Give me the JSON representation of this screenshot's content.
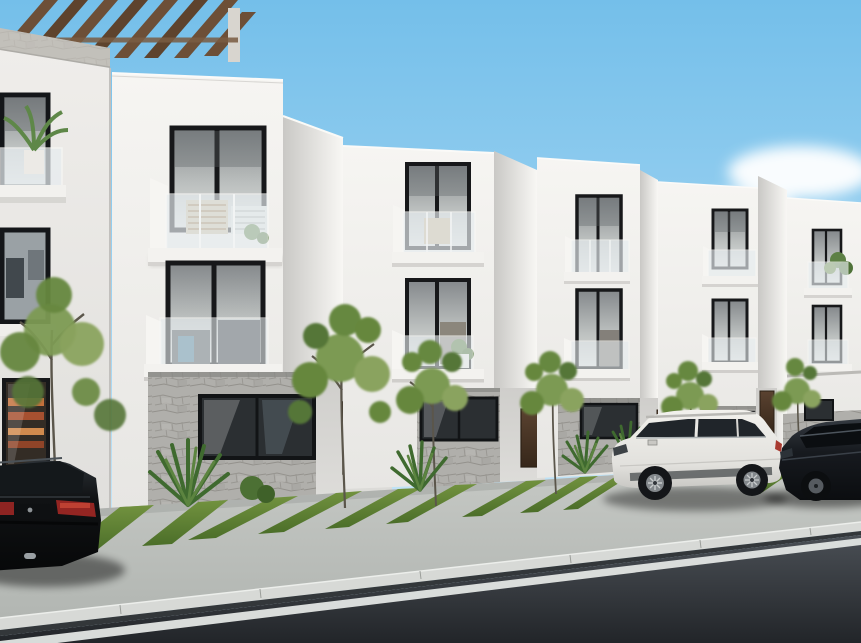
{
  "scene": {
    "type": "architectural-exterior-render",
    "description": "Photorealistic 3D exterior rendering of a row of modern white three-storey townhouses seen in perspective receding to the right. Black-framed windows, white Juliet balconies with glass railings, gray stone-clad ground floors, dark wood entry doors, landscaped front yards with small trees, agave plants and alternating grass and concrete driveway strips. A black sedan is parked at the lower left (rear view), a white wagon and a dark sedan are parked in driveways to the right. Light gray sidewalk and curb with a dark asphalt street and white edge line in the foreground, under a clear blue sky with soft clouds on the right. A wood slat pergola tops the closest building at the upper left.",
    "sky": {
      "top_color": "#76c0ea",
      "horizon_color": "#d7ecf8",
      "cloud_color": "#ffffff",
      "clouds_position": "soft clouds at the right, mid height"
    },
    "buildings": {
      "townhouse_units_visible": 5,
      "plus_foreground_building": 1,
      "storeys": 3,
      "style": "modern minimalist stepped white volumes",
      "facade_color": "#f3f2ef",
      "side_wall_color": "#d7d6d3",
      "window_frame_color": "#17181a",
      "upper_glass_color": "#9aa0a2",
      "ground_glass_color": "#2b2f32",
      "balcony": "white box balconies with frameless glass railings, wood slat screens and potted plants",
      "balcony_glass_color": "#e4ebee",
      "stone_cladding_color": "#b0afab",
      "entry_door_color": "#4e3827",
      "pergola_wood_color": "#6d4f37",
      "accent_blue_glass": "#4f86a0"
    },
    "vehicles": [
      {
        "name": "black-sedan",
        "color": "#0b0d0f",
        "taillight_color": "#b03226",
        "position": "bottom left, rear view"
      },
      {
        "name": "white-wagon",
        "color": "#eae9e5",
        "position": "parked in right driveway, side view facing left"
      },
      {
        "name": "dark-sedan",
        "color": "#171a1f",
        "position": "far right edge, partially cropped"
      }
    ],
    "landscaping": {
      "grass_color": "#5d7c34",
      "front_yard_trees": 6,
      "agave_color": "#3f6a2f",
      "background_foliage_color": "#35512a",
      "driveways": "concrete strips alternating with angled grass bands"
    },
    "street": {
      "sidewalk_color": "#bcc0bc",
      "curb_color": "#d7d9d6",
      "gutter_color": "#33373a",
      "asphalt_color": "#2b2f34",
      "edge_line_color": "#e3e6e4"
    }
  }
}
